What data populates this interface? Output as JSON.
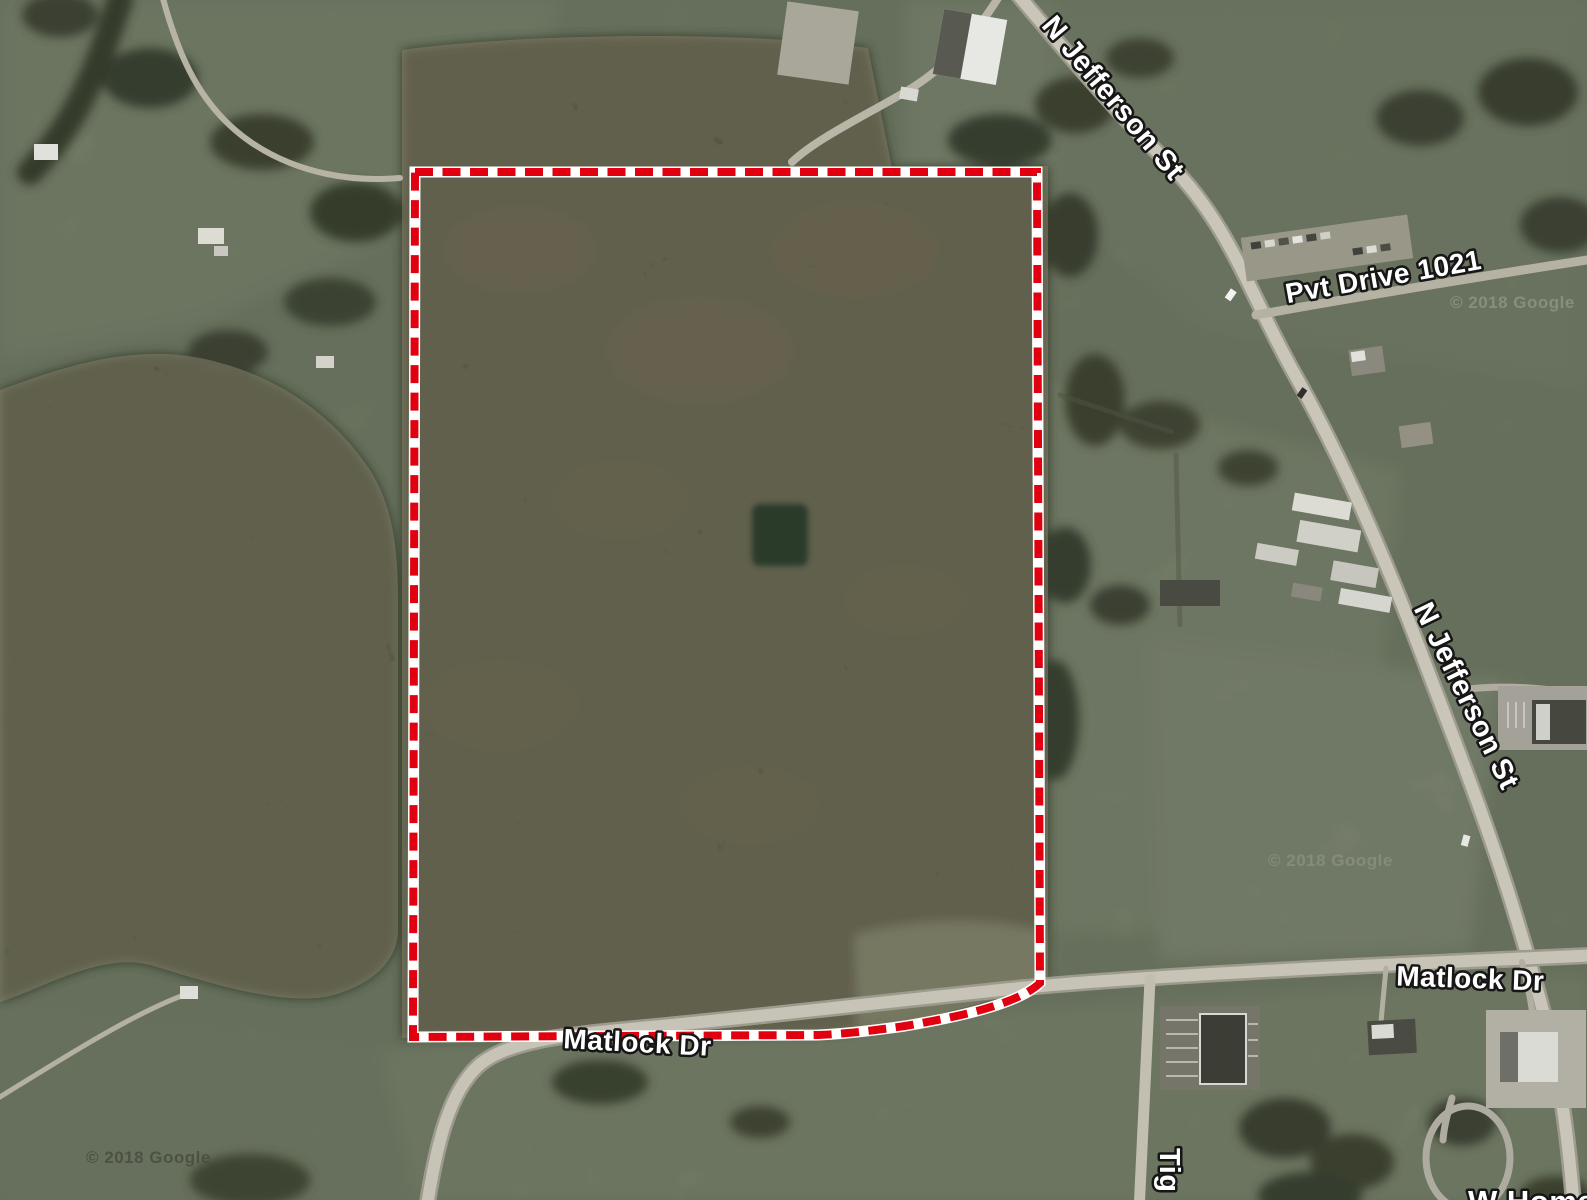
{
  "map": {
    "view": "satellite",
    "road_labels": {
      "jefferson_top": "N Jefferson St",
      "jefferson_mid": "N Jefferson St",
      "pvt_drive": "Pvt Drive 1021",
      "matlock_right": "Matlock Dr",
      "matlock_center": "Matlock Dr",
      "tig_partial": "Tig",
      "w_home_partial": "W Home"
    },
    "watermarks": {
      "bottom_left": "© 2018 Google",
      "mid_right": "© 2018 Google",
      "top_right": "© 2018 Google"
    },
    "boundary": {
      "style": "dashed",
      "stroke_color": "#e00010",
      "casing_color": "#ffffff"
    }
  }
}
